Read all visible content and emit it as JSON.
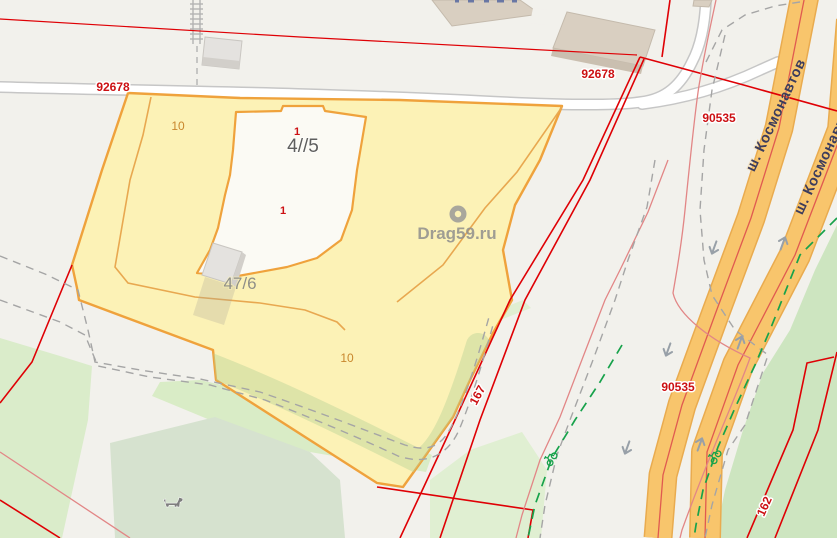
{
  "map": {
    "watermark": {
      "text": "Drag59.ru"
    },
    "labels": {
      "parcel_92678_left": "92678",
      "parcel_92678_top": "92678",
      "parcel_90535_top": "90535",
      "parcel_90535_bottom": "90535",
      "parcel_167": "167",
      "parcel_162": "162",
      "subparcel_10_top": "10",
      "subparcel_10_bottom": "10",
      "building_47_5": "4//5",
      "building_47_6": "47/6",
      "point_1_sup": "1",
      "point_1_main": "1",
      "street_kosmonavtov_left": "ш. Космонавтов",
      "street_kosmonavtov_right": "ш. Космонавтов"
    },
    "colors": {
      "background": "#f2f1ec",
      "cadastral_red": "#df0005",
      "label_red": "#cc1013",
      "parcel_fill": "#fcf2b6",
      "parcel_border": "#efa23c",
      "highway_fill": "#f8c56c",
      "park_green": "#daecca",
      "bikepath_green": "#17a24b",
      "street_label_navy": "#3c3c5c",
      "watermark_gray": "#8f8f8d"
    },
    "icons": [
      "location-pin-icon",
      "dog-icon",
      "bicycle-icon",
      "direction-arrow-icon"
    ]
  }
}
